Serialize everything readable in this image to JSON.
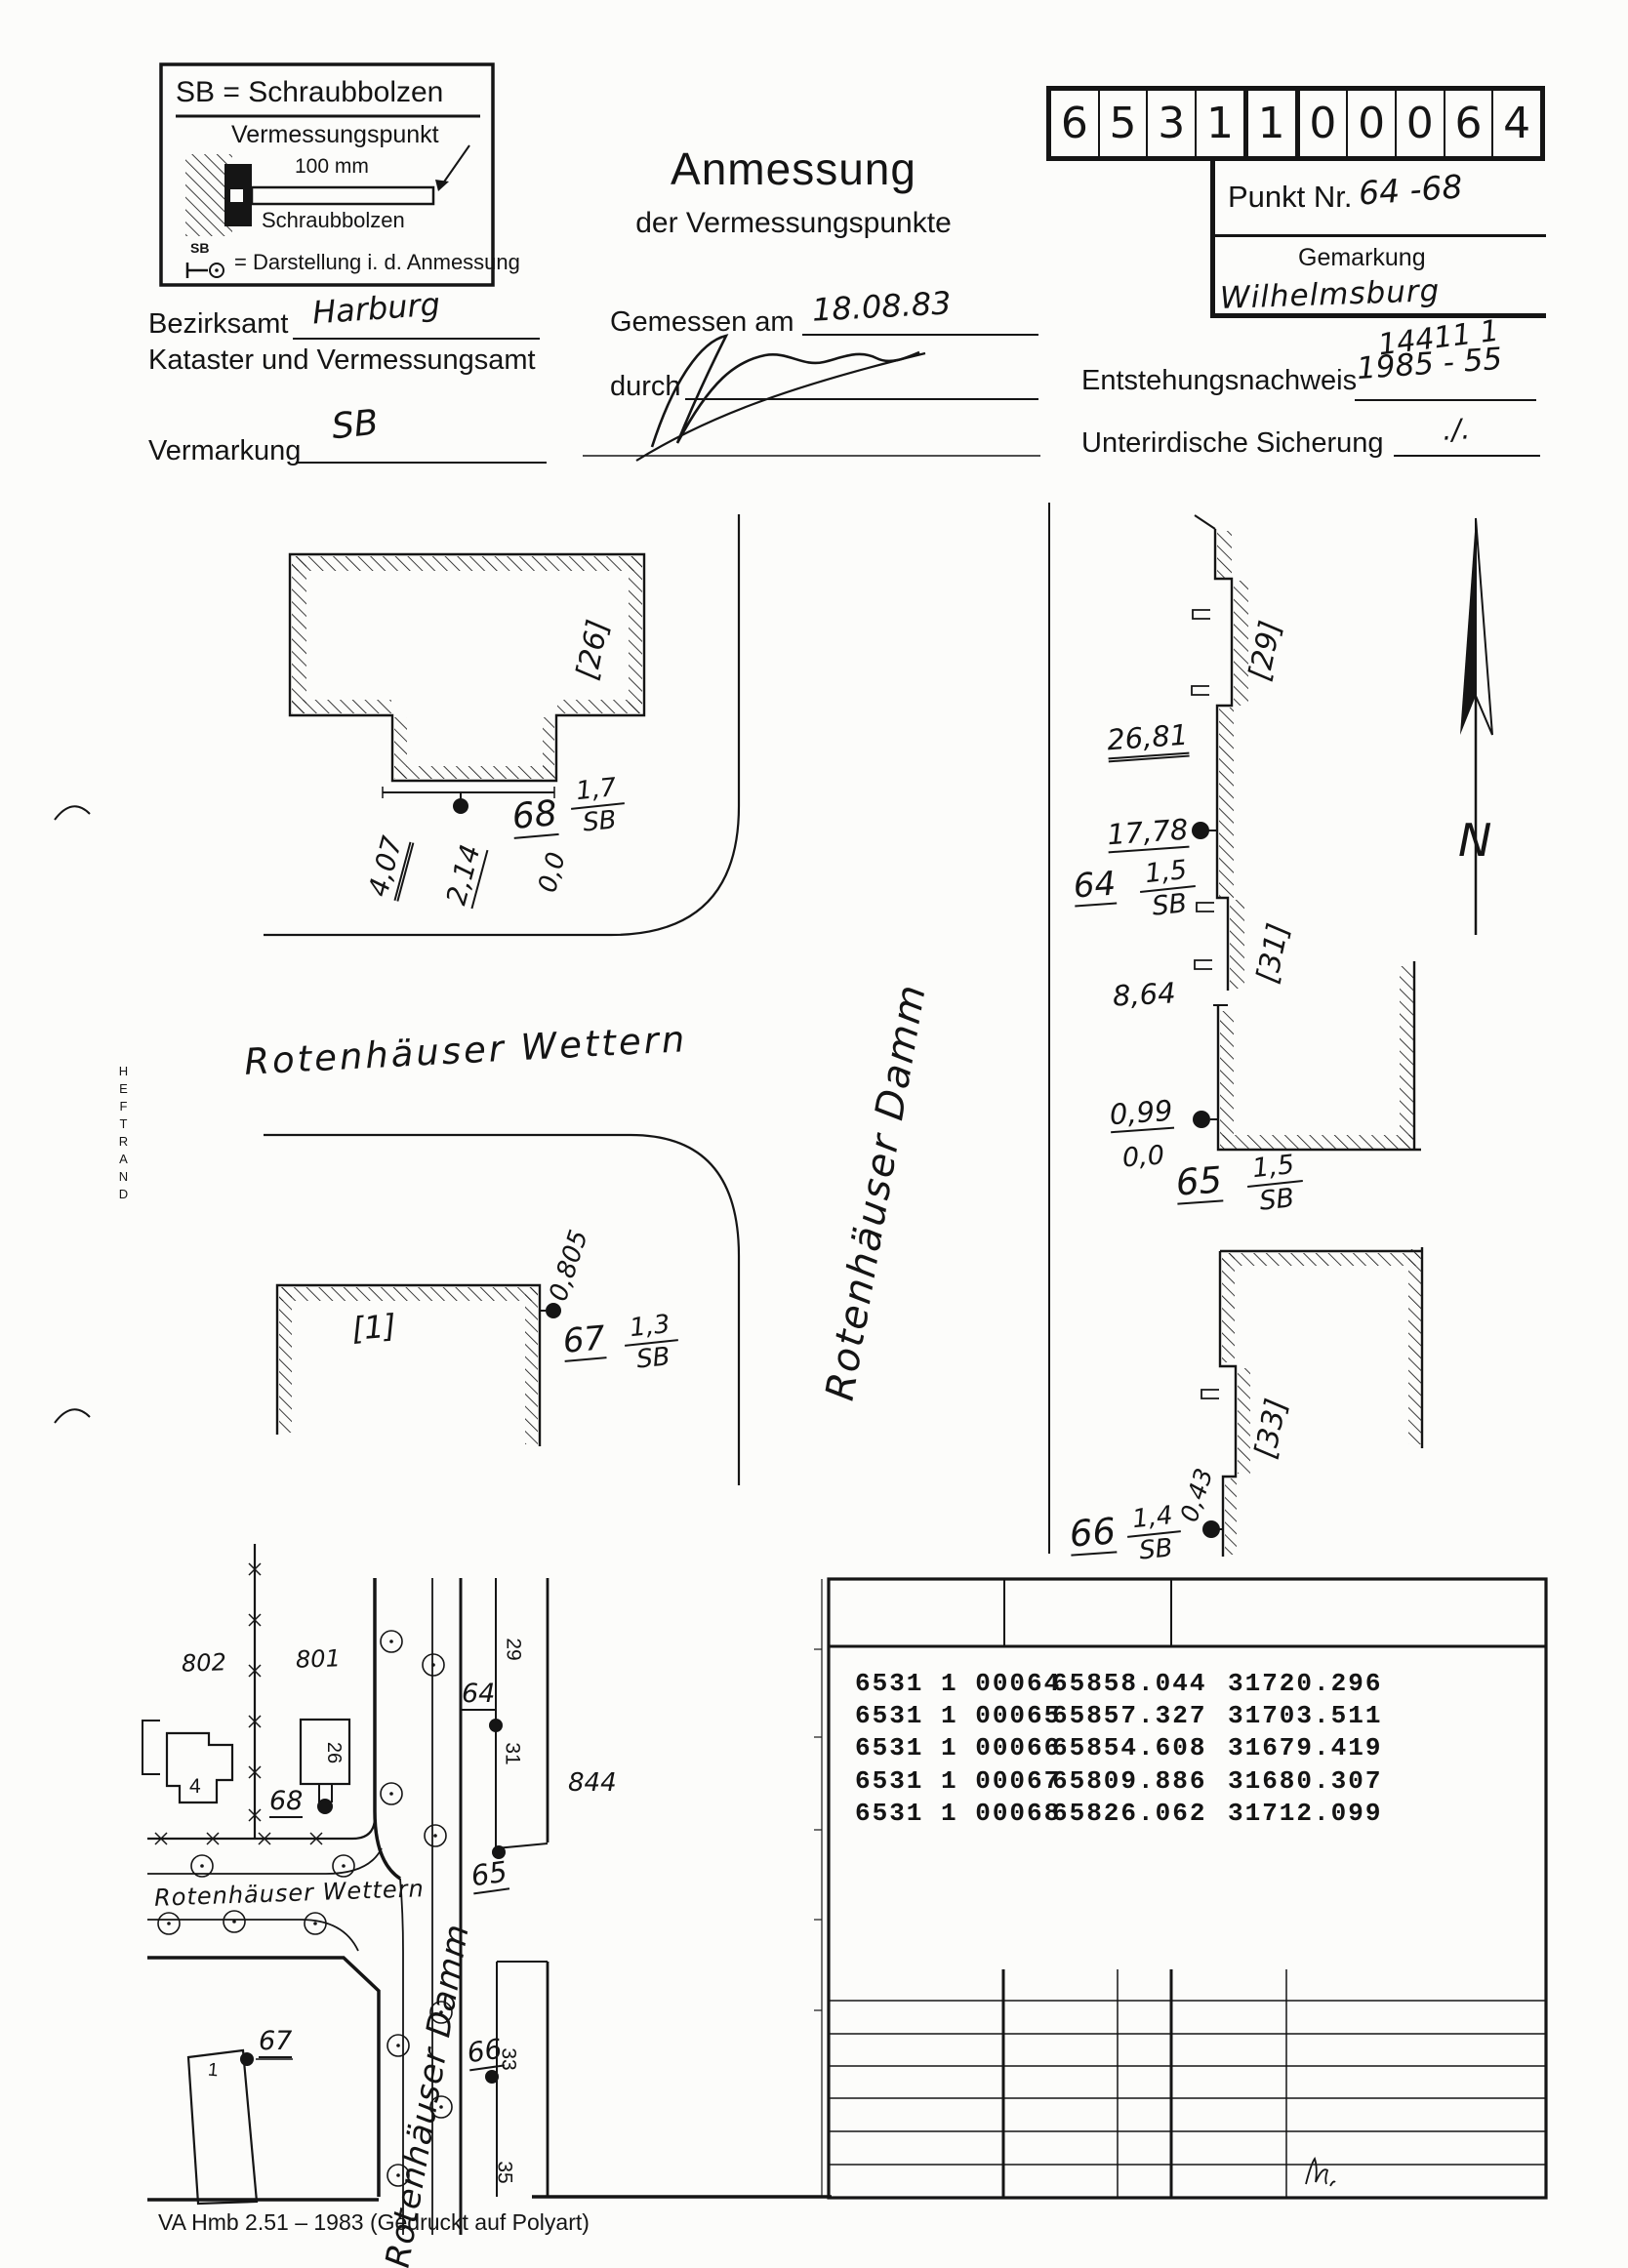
{
  "legend": {
    "title": "SB = Schraubbolzen",
    "point_label": "Vermessungspunkt",
    "dim_label": "100 mm",
    "bolt_label": "Schraubbolzen",
    "sb_small": "SB",
    "darstellung": "= Darstellung i. d. Anmessung"
  },
  "title": {
    "main": "Anmessung",
    "sub": "der Vermessungspunkte"
  },
  "code_digits": [
    "6",
    "5",
    "3",
    "1",
    "1",
    "0",
    "0",
    "0",
    "6",
    "4"
  ],
  "punkt": {
    "label": "Punkt Nr.",
    "value": "64 -68",
    "gemarkung_label": "Gemarkung",
    "gemarkung_value": "Wilhelmsburg",
    "scribble": "14411 1"
  },
  "form": {
    "bezirksamt_label": "Bezirksamt",
    "bezirksamt_value": "Harburg",
    "kataster_label": "Kataster und Vermessungsamt",
    "gemessen_label": "Gemessen am",
    "gemessen_value": "18.08.83",
    "durch_label": "durch",
    "entstehung_label": "Entstehungsnachweis",
    "entstehung_value": "1985 - 55",
    "vermarkung_label": "Vermarkung",
    "vermarkung_value": "SB",
    "sicherung_label": "Unterirdische Sicherung",
    "sicherung_value": "./."
  },
  "sketch": {
    "heftrand": "HEFTRAND",
    "wettern": "Rotenhäuser Wettern",
    "damm": "Rotenhäuser Damm",
    "north": "N",
    "b26": "[26]",
    "b29": "[29]",
    "b31": "[31]",
    "b1": "[1]",
    "b33": "[33]",
    "m_407": "4,07",
    "m_214": "2,14",
    "m_00a": "0,0",
    "p68": {
      "id": "68",
      "num": "1,7",
      "den": "SB"
    },
    "m_2681": "26,81",
    "m_1778": "17,78",
    "p64": {
      "id": "64",
      "num": "1,5",
      "den": "SB"
    },
    "m_864": "8,64",
    "m_099": "0,99",
    "m_00b": "0,0",
    "p65": {
      "id": "65",
      "num": "1,5",
      "den": "SB"
    },
    "m_0805": "0,805",
    "p67": {
      "id": "67",
      "num": "1,3",
      "den": "SB"
    },
    "m_043": "0,43",
    "p66": {
      "id": "66",
      "num": "1,4",
      "den": "SB"
    }
  },
  "map": {
    "wettern": "Rotenhäuser Wettern",
    "damm": "Rotenhäuser Damm",
    "parcel_802": "802",
    "parcel_801": "801",
    "parcel_844": "844",
    "house_4": "4",
    "house_26": "26",
    "house_1": "1",
    "lot_29": "29",
    "lot_31": "31",
    "lot_33": "33",
    "lot_35": "35",
    "pt_68": "68",
    "pt_64": "64",
    "pt_65": "65",
    "pt_66": "66",
    "pt_67": "67"
  },
  "table": {
    "rows": [
      {
        "nr": "6531 1 00064",
        "x": "65858.044",
        "y": "31720.296"
      },
      {
        "nr": "6531 1 00065",
        "x": "65857.327",
        "y": "31703.511"
      },
      {
        "nr": "6531 1 00066",
        "x": "65854.608",
        "y": "31679.419"
      },
      {
        "nr": "6531 1 00067",
        "x": "65809.886",
        "y": "31680.307"
      },
      {
        "nr": "6531 1 00068",
        "x": "65826.062",
        "y": "31712.099"
      }
    ]
  },
  "footer": "VA Hmb 2.51 – 1983 (Gedruckt auf Polyart)"
}
